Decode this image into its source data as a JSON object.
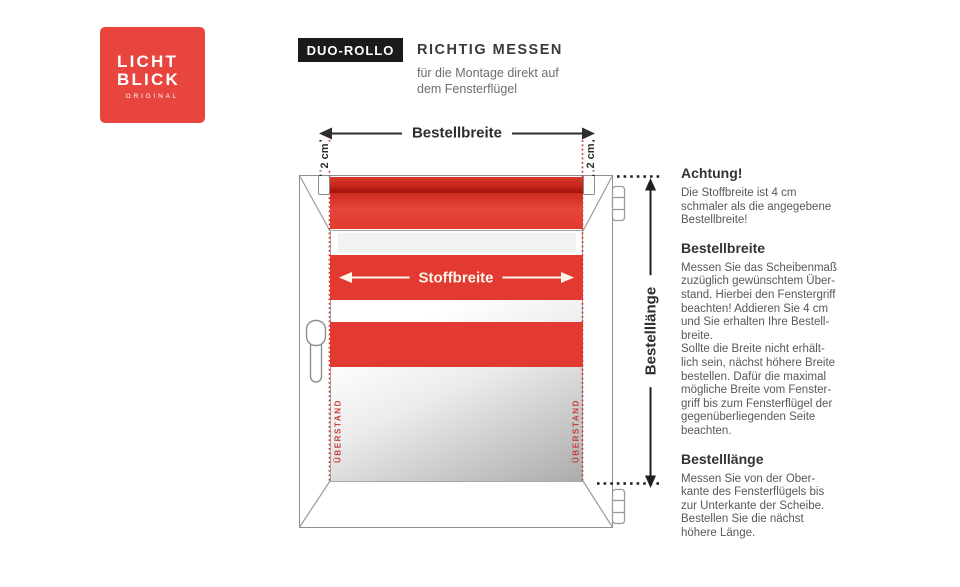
{
  "logo": {
    "line1": "LICHT",
    "line2": "BLICK",
    "subtext": "ORIGINAL",
    "bg_color": "#e8453e"
  },
  "header": {
    "badge": "DUO-ROLLO",
    "title": "RICHTIG MESSEN",
    "subtitle": "für die Montage direkt auf\ndem Fensterflügel"
  },
  "diagram": {
    "labels": {
      "order_width": "Bestellbreite",
      "offset_left": "2 cm",
      "offset_right": "2 cm",
      "fabric_width": "Stoffbreite",
      "order_length": "Bestelllänge",
      "overhang_left": "ÜBERSTAND",
      "overhang_right": "ÜBERSTAND"
    },
    "colors": {
      "blind_red": "#e23a31",
      "roller_dark_red": "#9f1209",
      "dotted_red": "#cf3129",
      "frame_gray": "#8f8f8f",
      "badge_black": "#1b1b1b"
    }
  },
  "info": {
    "sections": [
      {
        "heading": "Achtung!",
        "body": "Die Stoffbreite ist 4 cm\nschmaler als die angegebene\nBestellbreite!"
      },
      {
        "heading": "Bestellbreite",
        "body": "Messen Sie das Scheibenmaß\nzuzüglich gewünschtem Über-\nstand. Hierbei den Fenstergriff\nbeachten! Addieren Sie 4 cm\nund Sie erhalten Ihre Bestell-\nbreite.\nSollte die Breite nicht erhält-\nlich sein, nächst höhere Breite\nbestellen. Dafür die maximal\nmögliche Breite vom Fenster-\ngriff bis zum Fensterflügel der\ngegenüberliegenden Seite\nbeachten."
      },
      {
        "heading": "Bestelllänge",
        "body": "Messen Sie von der Ober-\nkante des Fensterflügels bis\nzur Unterkante der Scheibe.\nBestellen Sie die nächst\nhöhere Länge."
      }
    ]
  }
}
